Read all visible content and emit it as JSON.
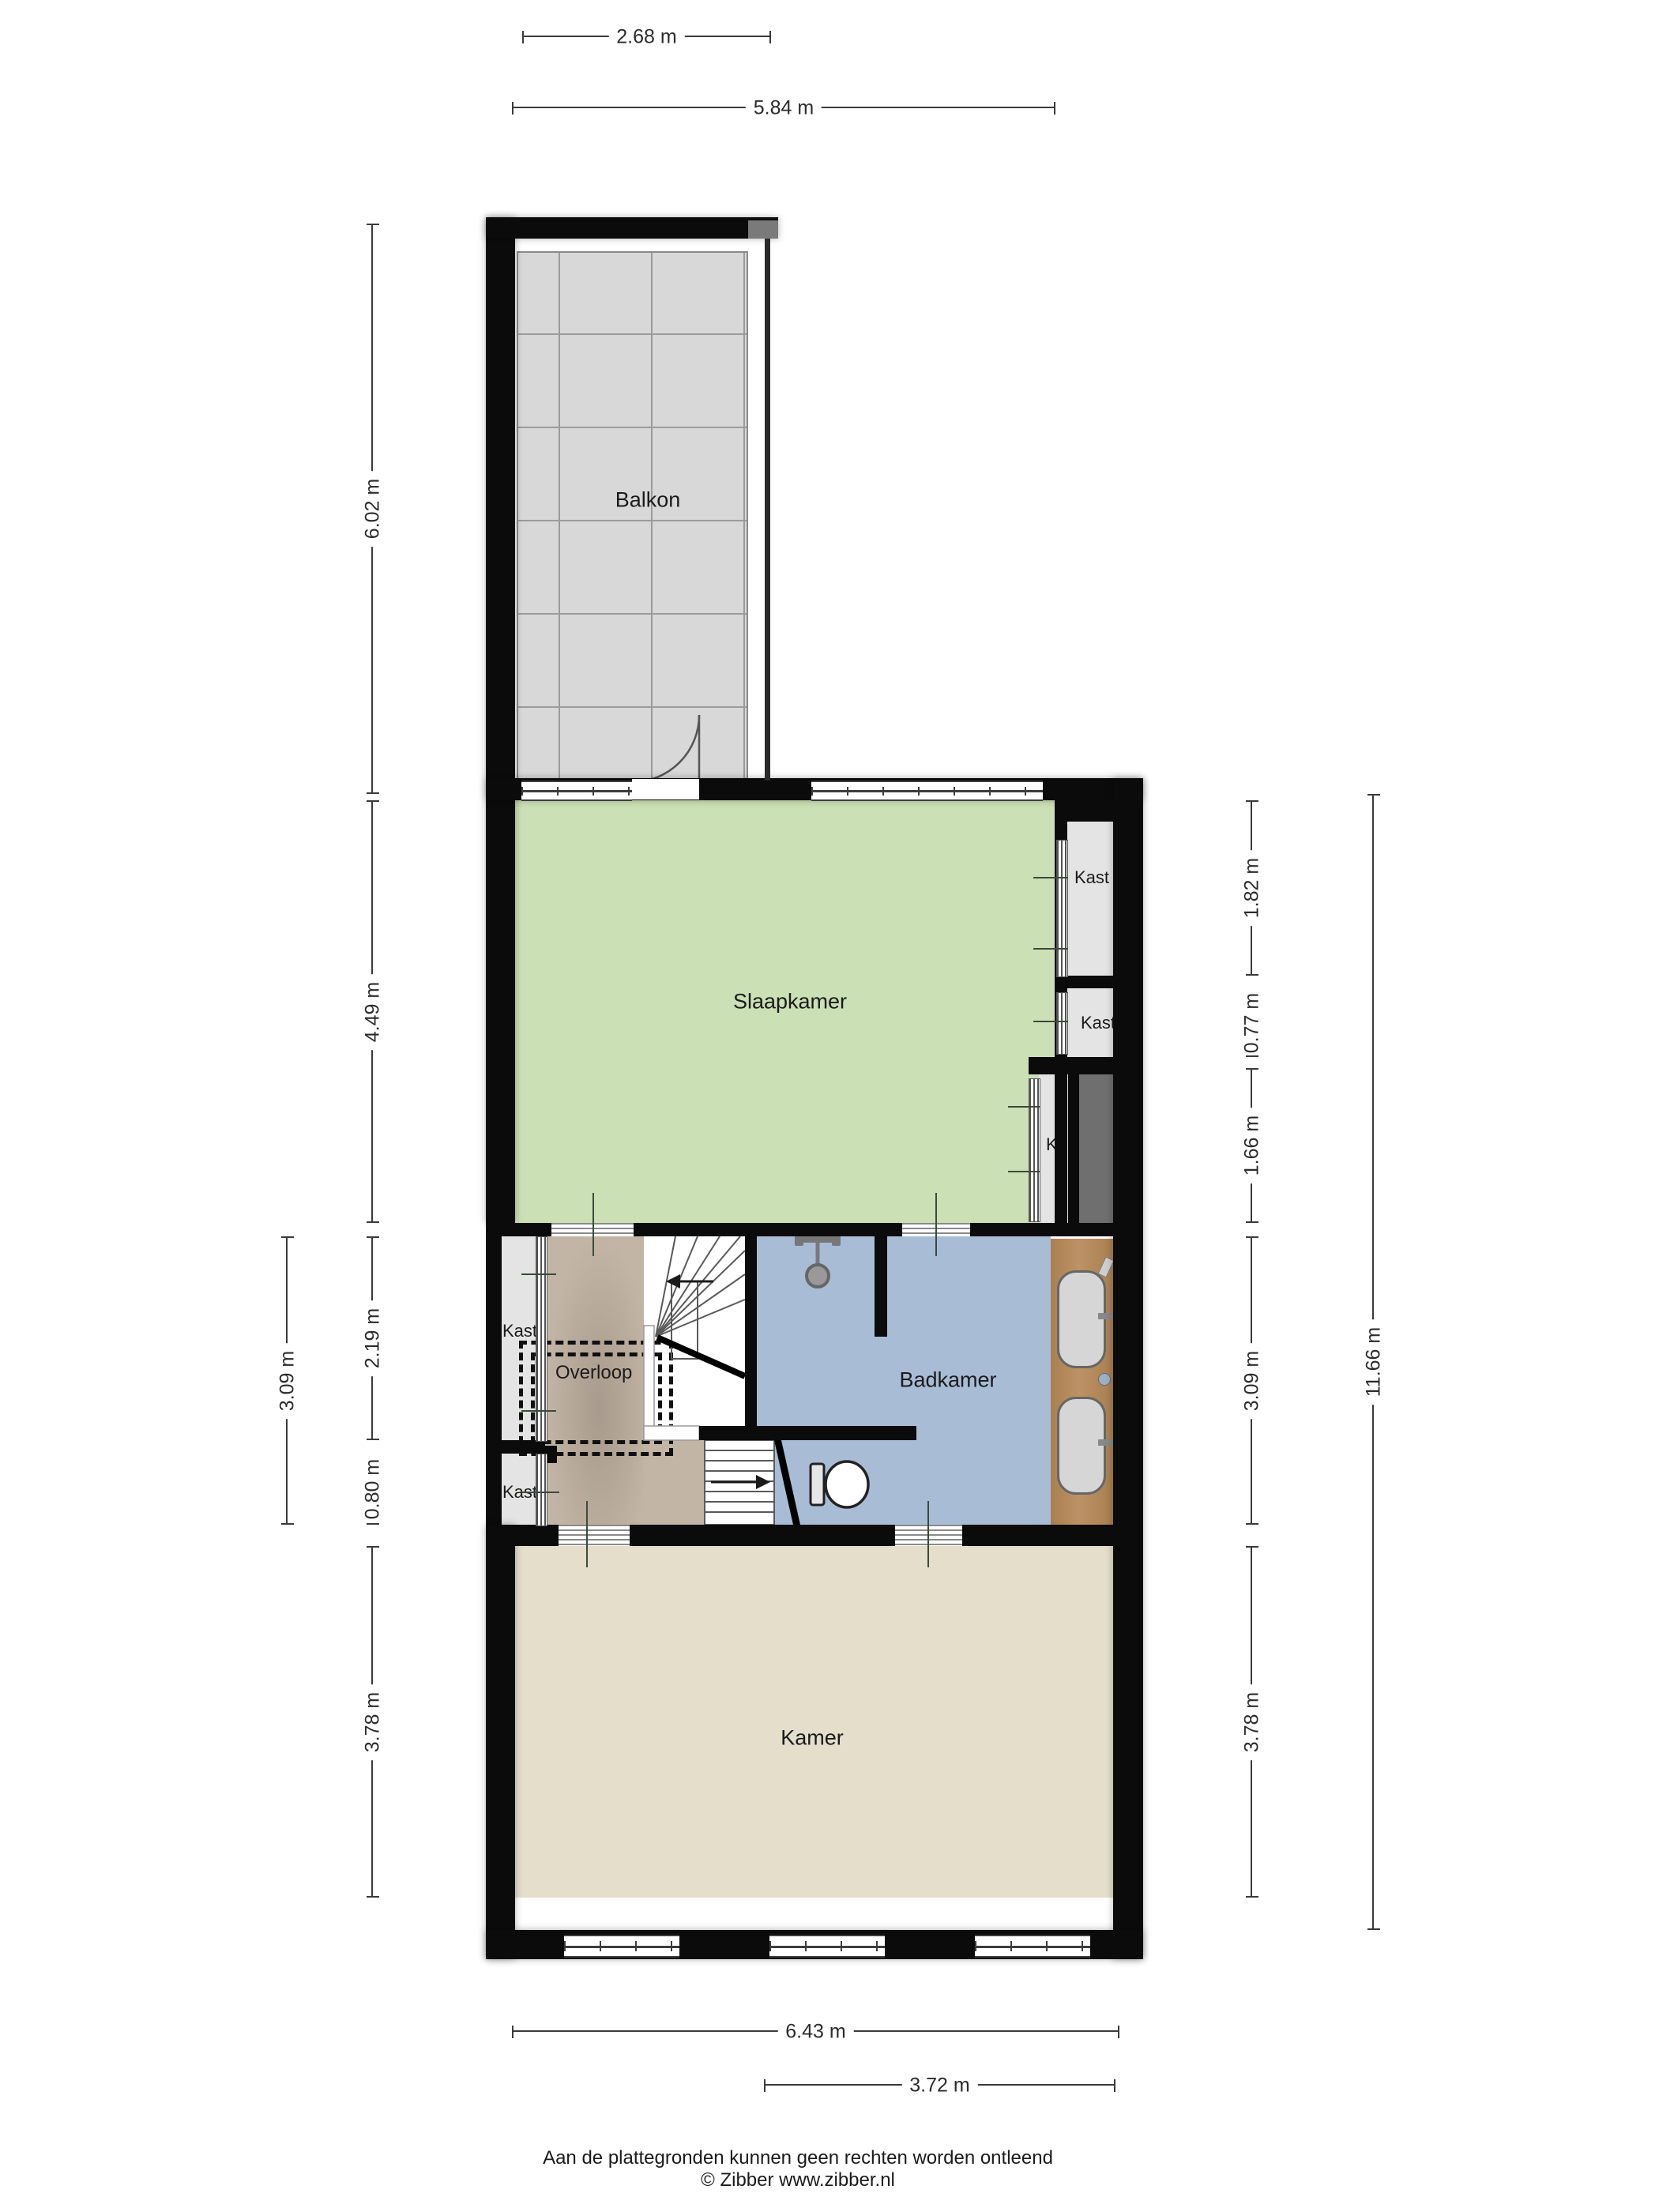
{
  "rooms": {
    "balkon": {
      "label": "Balkon"
    },
    "slaapkamer": {
      "label": "Slaapkamer"
    },
    "badkamer": {
      "label": "Badkamer"
    },
    "overloop": {
      "label": "Overloop"
    },
    "kamer": {
      "label": "Kamer"
    },
    "kast_right_top": {
      "label": "Kast"
    },
    "kast_right_mid": {
      "label": "Kast"
    },
    "closet_k": {
      "label": "K"
    },
    "kast_left_top": {
      "label": "Kast"
    },
    "kast_left_bot": {
      "label": "Kast"
    }
  },
  "dimensions": {
    "top": [
      {
        "label": "2.68 m"
      },
      {
        "label": "5.84 m"
      }
    ],
    "bottom": [
      {
        "label": "6.43 m"
      },
      {
        "label": "3.72 m"
      }
    ],
    "left": [
      {
        "label": "6.02 m"
      },
      {
        "label": "4.49 m"
      },
      {
        "label": "3.09 m"
      },
      {
        "label": "2.19 m"
      },
      {
        "label": "0.80 m"
      },
      {
        "label": "3.78 m"
      }
    ],
    "right": [
      {
        "label": "1.82 m"
      },
      {
        "label": "0.77 m"
      },
      {
        "label": "1.66 m"
      },
      {
        "label": "3.09 m"
      },
      {
        "label": "3.78 m"
      },
      {
        "label": "11.66 m"
      }
    ]
  },
  "footer": {
    "line1": "Aan de plattegronden kunnen geen rechten worden ontleend",
    "line2": "© Zibber www.zibber.nl"
  },
  "colors": {
    "wall": "#0b0b0b",
    "bedroom_green": "#cbe0b4",
    "bathroom_blue": "#a8bcd6",
    "landing_tan": "#c3b5a5",
    "room_beige": "#e4decb",
    "balcony_tile": "#d8d8d8",
    "closet_gray": "#e4e4e4",
    "shaft_gray": "#6f6f6f",
    "counter_wood": "#b1895e"
  }
}
